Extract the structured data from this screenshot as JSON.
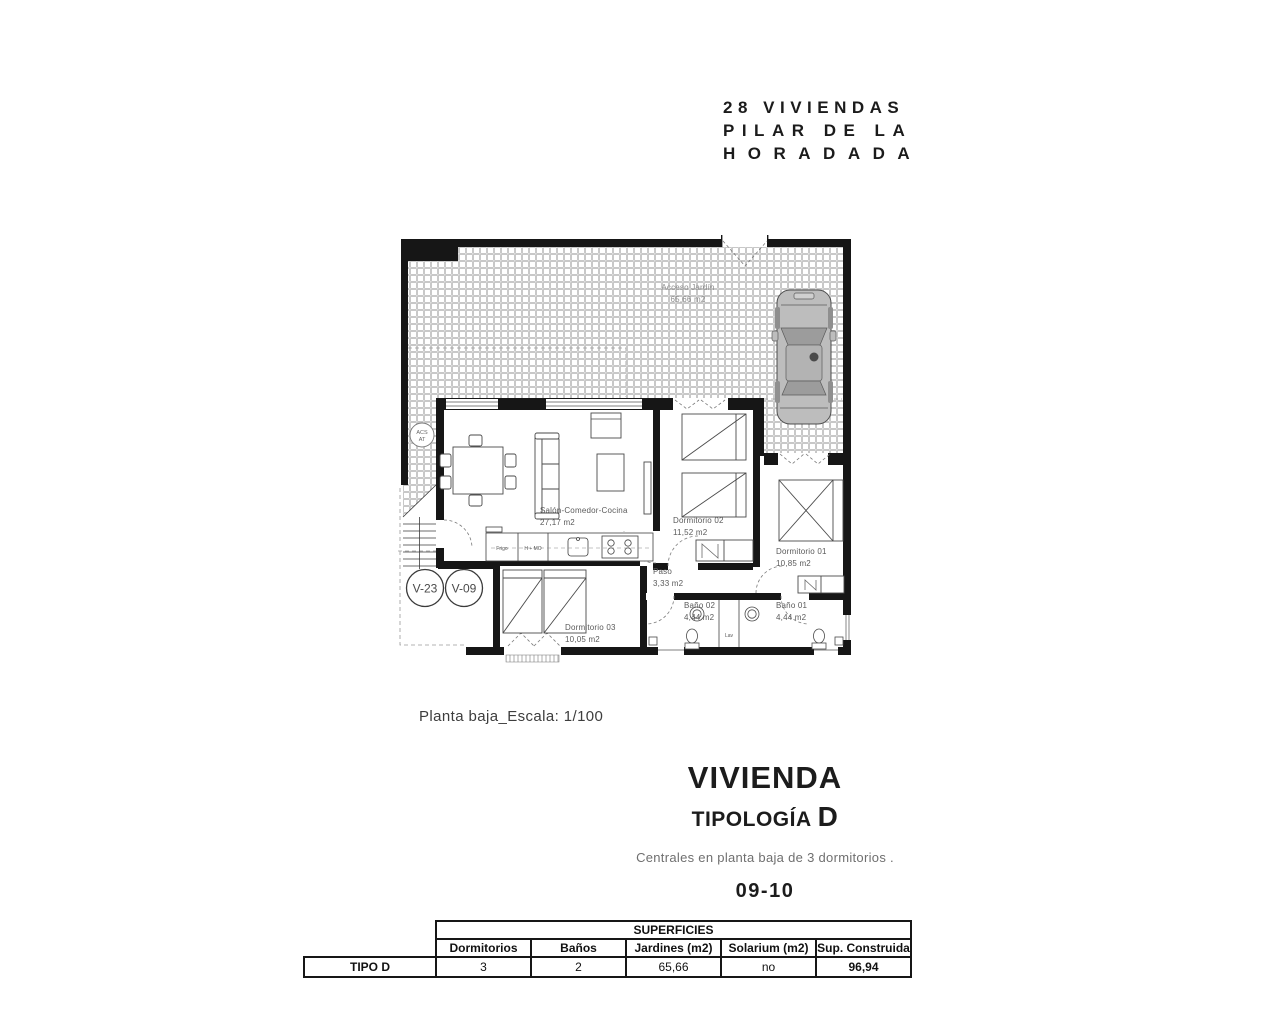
{
  "project": {
    "line1": "28 VIVIENDAS",
    "line2": "PILAR DE LA",
    "line3": "HORADADA"
  },
  "plan": {
    "scale_note": "Planta baja_Escala: 1/100",
    "rooms": {
      "salon": {
        "name": "Salón-Comedor-Cocina",
        "area": "27,17 m2"
      },
      "dorm02": {
        "name": "Dormitorio 02",
        "area": "11,52 m2"
      },
      "dorm01": {
        "name": "Dormitorio 01",
        "area": "10,85 m2"
      },
      "dorm03": {
        "name": "Dormitorio 03",
        "area": "10,05 m2"
      },
      "paso": {
        "name": "Paso",
        "area": "3,33 m2"
      },
      "bano02": {
        "name": "Baño 02",
        "area": "4,44 m2"
      },
      "bano01": {
        "name": "Baño 01",
        "area": "4,44 m2"
      },
      "acceso": {
        "name": "Acceso Jardín",
        "area": "65,66 m2"
      }
    },
    "labels": {
      "fridge": "Frigo",
      "oven": "H + MO",
      "laundry": "Lav",
      "acs_line1": "ACS",
      "acs_line2": "AT",
      "unit_a": "V-23",
      "unit_b": "V-09"
    }
  },
  "heading": {
    "title": "VIVIENDA",
    "subtitle": "TIPOLOGÍA",
    "type_letter": "D",
    "description": "Centrales en planta baja de 3 dormitorios .",
    "units": "09-10"
  },
  "table": {
    "section": "SUPERFICIES",
    "row_label": "TIPO D",
    "columns": [
      "Dormitorios",
      "Baños",
      "Jardines (m2)",
      "Solarium (m2)",
      "Sup. Construida"
    ],
    "values": [
      "3",
      "2",
      "65,66",
      "no",
      "96,94"
    ]
  }
}
